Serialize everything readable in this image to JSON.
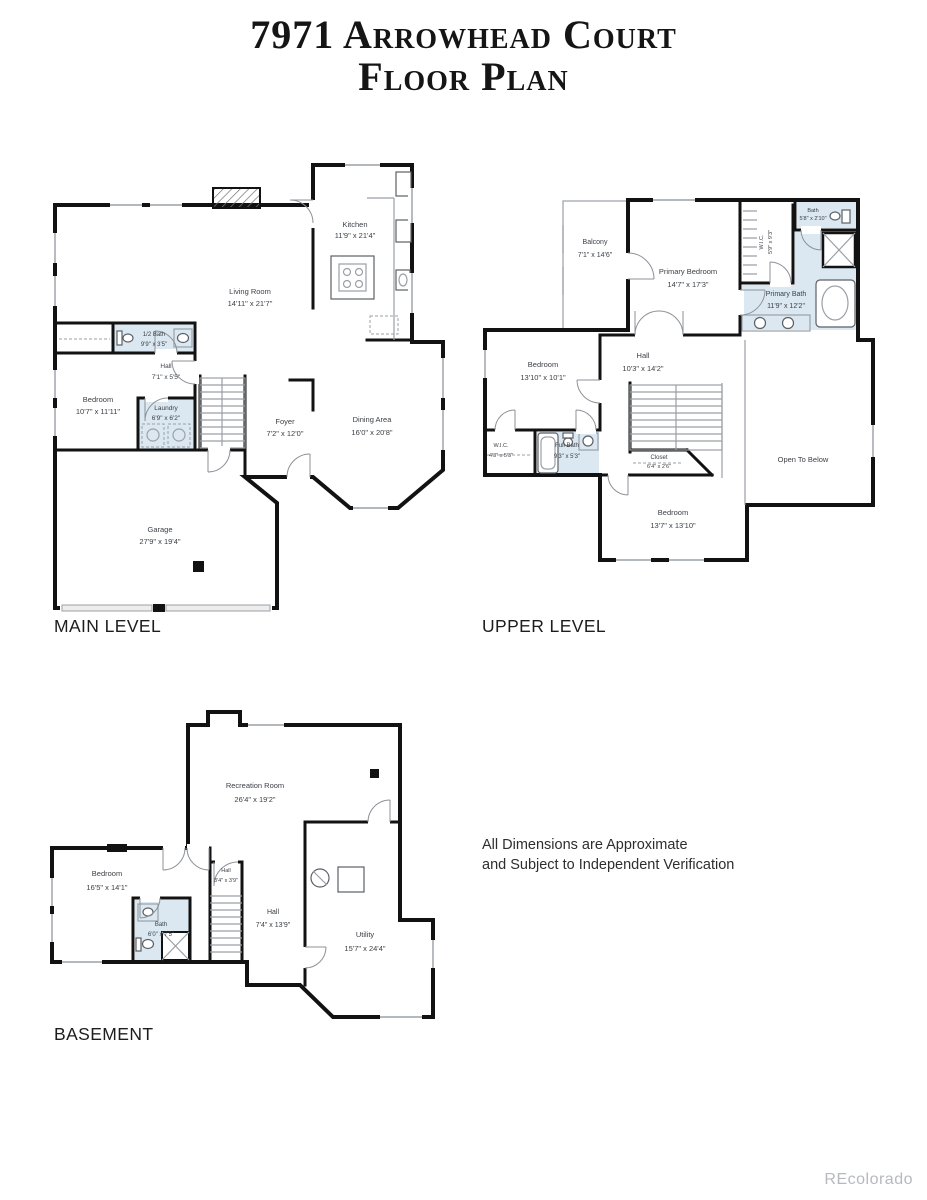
{
  "page": {
    "title_line1": "7971 Arrowhead Court",
    "title_line2": "Floor Plan",
    "disclaimer_line1": "All Dimensions are Approximate",
    "disclaimer_line2": "and Subject to Independent Verification",
    "watermark": "REcolorado"
  },
  "colors": {
    "wall": "#121212",
    "bath_fill": "#dbe8f1",
    "watermark": "#b6b9bf"
  },
  "levels": [
    {
      "label": "MAIN LEVEL",
      "rooms": [
        {
          "name": "Kitchen",
          "dims": "11'9\" x 21'4\""
        },
        {
          "name": "Living Room",
          "dims": "14'11\" x 21'7\""
        },
        {
          "name": "1/2 Bath",
          "dims": "9'9\" x 3'5\""
        },
        {
          "name": "Hall",
          "dims": "7'1\" x 5'5\""
        },
        {
          "name": "Bedroom",
          "dims": "10'7\" x 11'11\""
        },
        {
          "name": "Laundry",
          "dims": "6'9\" x 6'2\""
        },
        {
          "name": "Foyer",
          "dims": "7'2\" x 12'0\""
        },
        {
          "name": "Dining Area",
          "dims": "16'0\" x 20'8\""
        },
        {
          "name": "Garage",
          "dims": "27'9\" x 19'4\""
        }
      ]
    },
    {
      "label": "UPPER LEVEL",
      "rooms": [
        {
          "name": "Balcony",
          "dims": "7'1\" x 14'6\""
        },
        {
          "name": "Primary Bedroom",
          "dims": "14'7\" x 17'3\""
        },
        {
          "name": "W.I.C.",
          "dims": "5'9\" x 9'3\""
        },
        {
          "name": "Bath",
          "dims": "5'8\" x 2'10\""
        },
        {
          "name": "Primary Bath",
          "dims": "11'9\" x 12'2\""
        },
        {
          "name": "Bedroom",
          "dims": "13'10\" x 10'1\""
        },
        {
          "name": "Hall",
          "dims": "10'3\" x 14'2\""
        },
        {
          "name": "W.I.C.",
          "dims": "4'3\" x 5'3\""
        },
        {
          "name": "Full Bath",
          "dims": "9'3\" x 5'3\""
        },
        {
          "name": "Open To Below",
          "dims": ""
        },
        {
          "name": "Closet",
          "dims": "6'4\" x 2'6\""
        },
        {
          "name": "Bedroom",
          "dims": "13'7\" x 13'10\""
        }
      ]
    },
    {
      "label": "BASEMENT",
      "rooms": [
        {
          "name": "Recreation Room",
          "dims": "26'4\" x 19'2\""
        },
        {
          "name": "Bedroom",
          "dims": "16'5\" x 14'1\""
        },
        {
          "name": "Bath",
          "dims": "6'0\" x 7'5\""
        },
        {
          "name": "Hall",
          "dims": "3'4\" x 3'9\""
        },
        {
          "name": "Hall",
          "dims": "7'4\" x 13'9\""
        },
        {
          "name": "Utility",
          "dims": "15'7\" x 24'4\""
        }
      ]
    }
  ]
}
